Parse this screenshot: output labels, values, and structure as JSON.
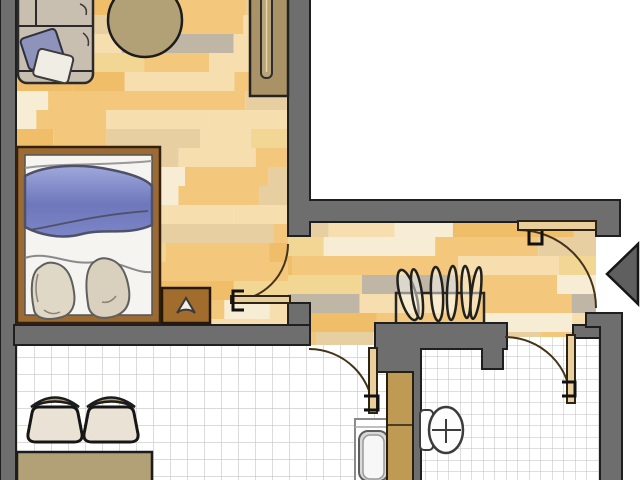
{
  "plan": {
    "type": "apartment-floor-plan",
    "rooms": [
      {
        "id": "living-bedroom",
        "floor": "parquet"
      },
      {
        "id": "hallway",
        "floor": "parquet"
      },
      {
        "id": "kitchen",
        "floor": "white-tile"
      },
      {
        "id": "bathroom",
        "floor": "white-tile"
      }
    ],
    "furniture": [
      "sofa",
      "round-table",
      "shelf-unit",
      "bed",
      "nightstand",
      "coat-rack",
      "chair",
      "chair",
      "kitchen-table",
      "kitchen-sink",
      "cabinet",
      "toilet"
    ],
    "doors": [
      "living-room-door",
      "entrance-door",
      "kitchen-door",
      "bathroom-door"
    ],
    "entrance_marker": "left-pointing-triangle"
  },
  "colors": {
    "wall": "#6e6e6e",
    "wall_stroke": "#1f1f1f",
    "outline": "#1c1c1c",
    "tile_bg": "#ffffff",
    "tile_line_kitchen": "#c6c6c6",
    "tile_line_bath": "#bfbfbf",
    "furniture_tan": "#b2a077",
    "sofa_body": "#c8bfb1",
    "pillow_blue": "#8d93ba",
    "pillow_white": "#f0ede5",
    "blanket_light": "#a0a8dc",
    "blanket_dark": "#6d77bb",
    "bed_frame": "#9c6b33",
    "mattress": "#f5f4f0",
    "pillow_beige": "#e0d8c6",
    "pillow_beige2": "#d9d1be",
    "nightstand": "#a26d2c",
    "wardrobe": "#a99266",
    "cabinet": "#bf9a55",
    "chair_seat": "#eae2d4",
    "door_leaf": "#e9cf9b",
    "arrow": "#5f5f5f"
  },
  "floor_palette": [
    "#f3c87c",
    "#f6deae",
    "#f7ecd4",
    "#e7cfa2",
    "#bfb6a6",
    "#f0bd68",
    "#f2d694"
  ]
}
